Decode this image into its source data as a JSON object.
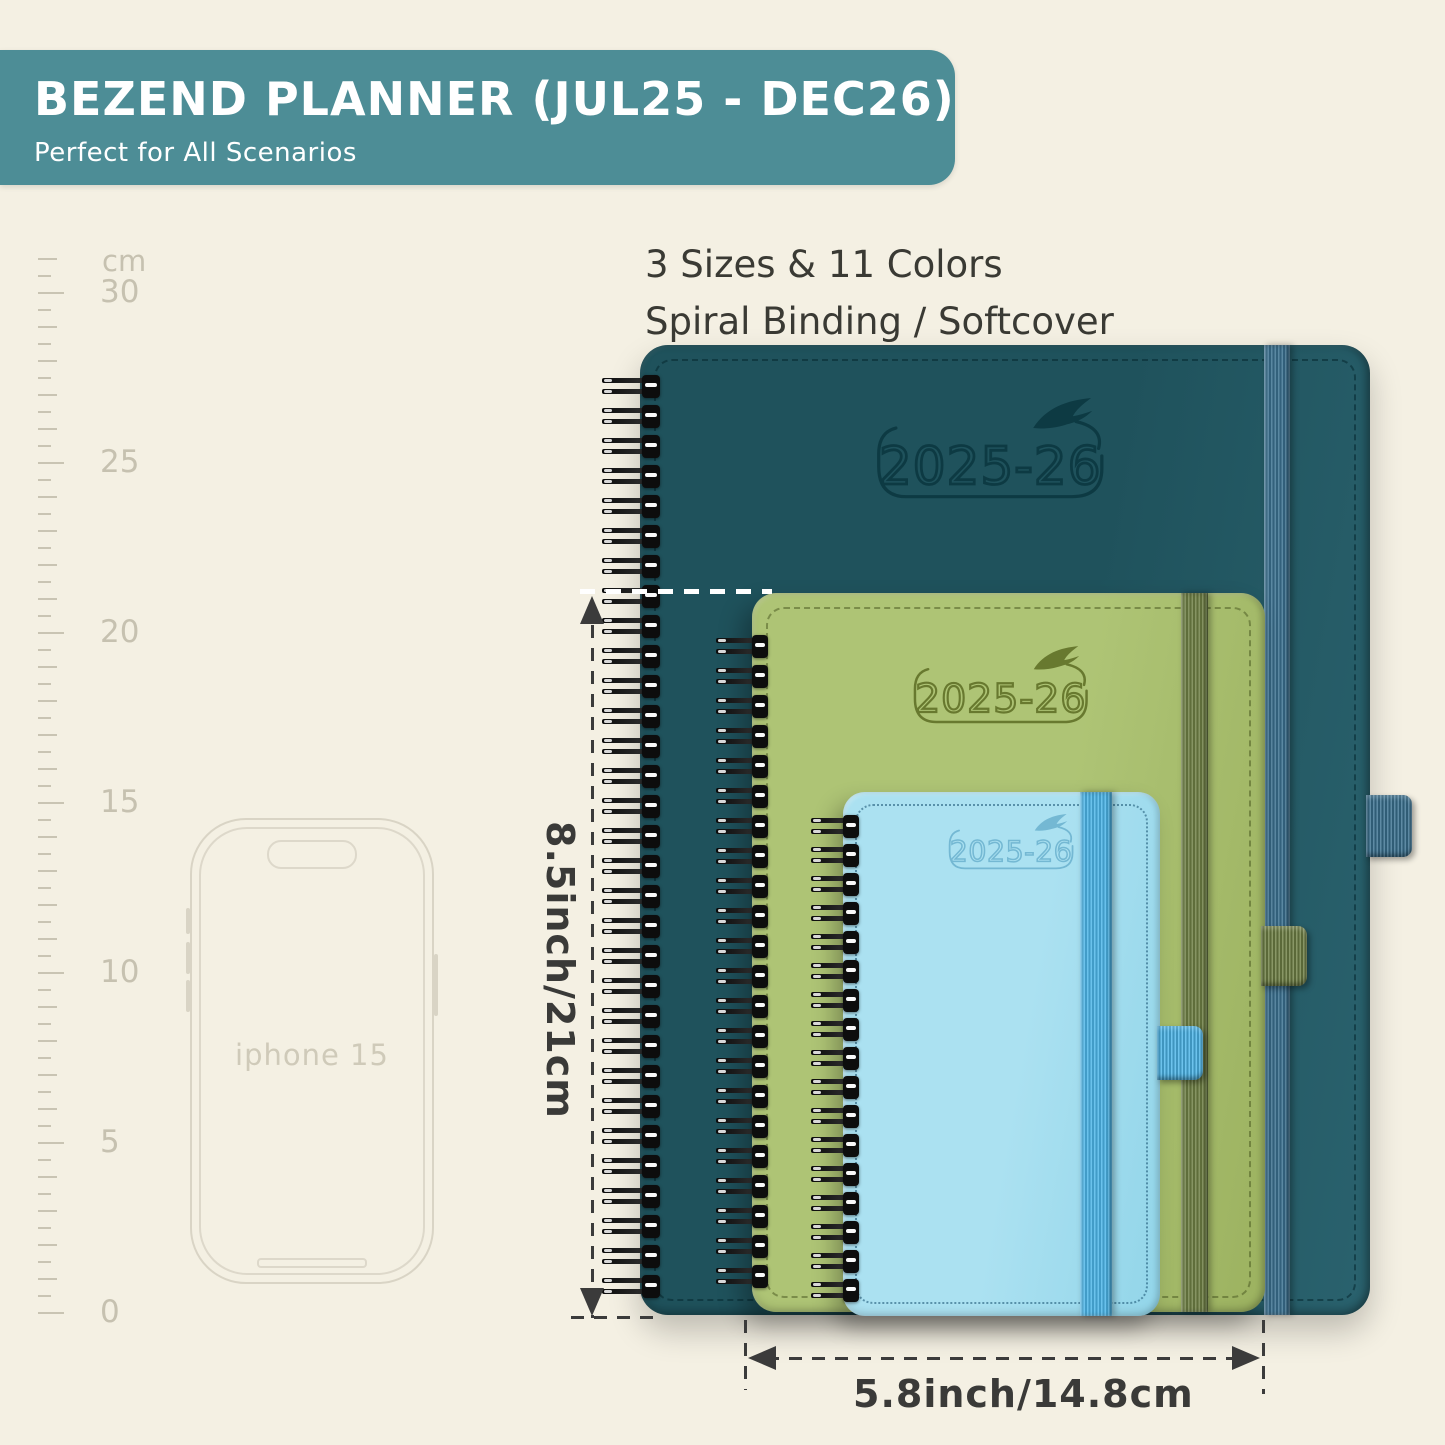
{
  "page_bg": "#f4f0e3",
  "banner": {
    "title": "BEZEND PLANNER (JUL25 - DEC26)",
    "subtitle": "Perfect for All Scenarios",
    "bg_color": "#4d8d96"
  },
  "headline": {
    "line1": "3 Sizes & 11 Colors",
    "line2": "Spiral Binding / Softcover"
  },
  "ruler": {
    "unit": "cm",
    "major_labels": [
      "30",
      "25",
      "20",
      "15",
      "10",
      "5",
      "0"
    ]
  },
  "phone": {
    "label": "iphone 15"
  },
  "planners": [
    {
      "name": "large-planner",
      "year": "2025-26",
      "colors": {
        "cover": "#1f525c",
        "cover2": "#2a626e",
        "elastic": "#3b7190",
        "stroke": "#0d3a43",
        "stitch": "rgba(6,40,48,0.55)"
      }
    },
    {
      "name": "medium-planner",
      "year": "2025-26",
      "colors": {
        "cover": "#aec475",
        "cover2": "#9cb260",
        "elastic": "#6f8045",
        "stroke": "#68792f",
        "stitch": "rgba(70,85,30,0.5)"
      }
    },
    {
      "name": "small-planner",
      "year": "2025-26",
      "colors": {
        "cover": "#abe1f1",
        "cover2": "#92d5e9",
        "elastic": "#4db6e9",
        "stroke": "#74b8d3",
        "stitch": "rgba(23,80,112,0.55)"
      }
    }
  ],
  "dimensions": {
    "height_label": "8.5inch/21cm",
    "width_label": "5.8inch/14.8cm"
  }
}
